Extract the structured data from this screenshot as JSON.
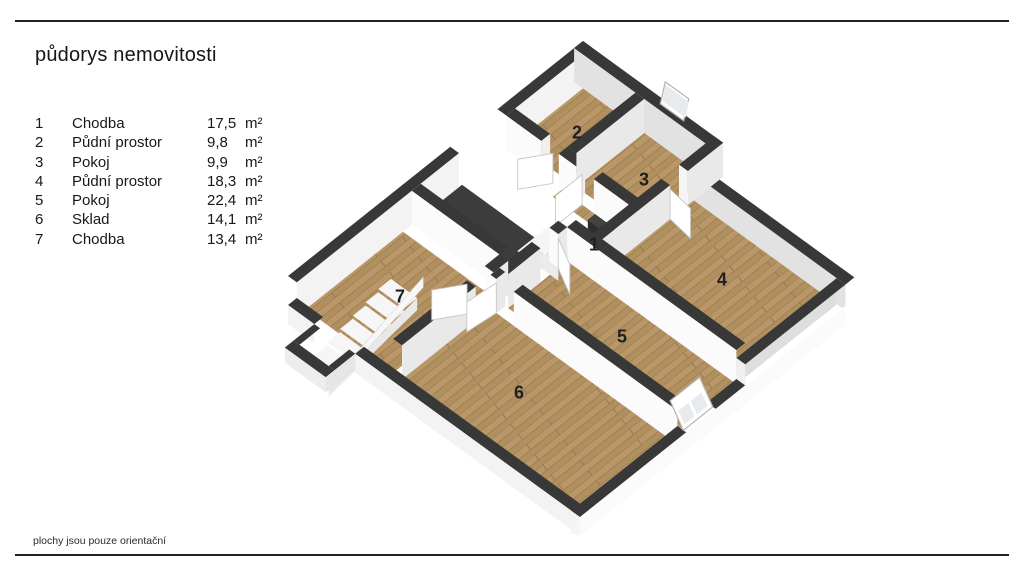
{
  "title": "půdorys nemovitosti",
  "footer_note": "plochy jsou pouze orientační",
  "rooms": [
    {
      "number": "1",
      "name": "Chodba",
      "area": "17,5",
      "unit": "m²"
    },
    {
      "number": "2",
      "name": "Půdní prostor",
      "area": "9,8",
      "unit": "m²"
    },
    {
      "number": "3",
      "name": "Pokoj",
      "area": "9,9",
      "unit": "m²"
    },
    {
      "number": "4",
      "name": "Půdní prostor",
      "area": "18,3",
      "unit": "m²"
    },
    {
      "number": "5",
      "name": "Pokoj",
      "area": "22,4",
      "unit": "m²"
    },
    {
      "number": "6",
      "name": "Sklad",
      "area": "14,1",
      "unit": "m²"
    },
    {
      "number": "7",
      "name": "Chodba",
      "area": "13,4",
      "unit": "m²"
    }
  ],
  "colors": {
    "wood": "#b19060",
    "wood_light": "#ba9768",
    "wood_dark": "#9a7a50",
    "wall_top": "#383838",
    "wall_face": "#fbfbfb",
    "wall_side": "#e9e9e9",
    "inner_ne": "#e2e2e2",
    "inner_nw": "#f3f3f3",
    "void_dark": "#3c3c3c",
    "skirt": "#f3f3f3",
    "stair_top": "#f6f6f6",
    "stair_riser": "#d9d9d9",
    "pane": "#e7ebed",
    "line": "#212121",
    "text": "#1a1a1a"
  }
}
